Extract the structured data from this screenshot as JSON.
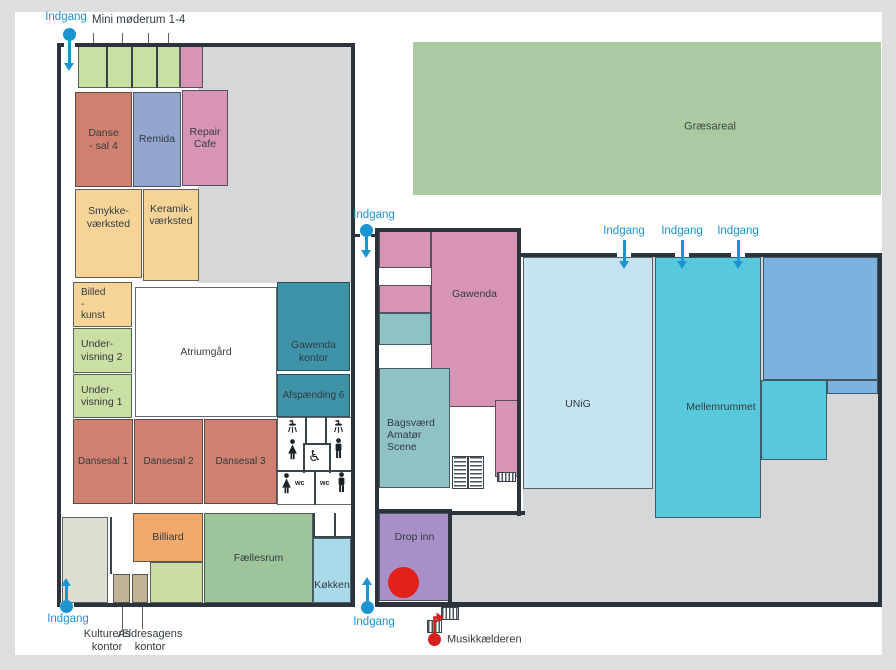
{
  "map": {
    "description": "Floor plan of community culture house with labelled rooms and entrances"
  },
  "colors": {
    "wall": "#2b343d",
    "accent_blue": "#1b95d2",
    "red": "#e2221a",
    "musik_red": "#d6201c",
    "interior_grey": "#d5d7d9",
    "grass_green": "#abcaa2"
  },
  "areas": [
    {
      "name": "left-building-interior",
      "x": 198,
      "y": 47,
      "w": 153,
      "h": 236,
      "bg": "#d5d7d9"
    },
    {
      "name": "right-building-interior",
      "x": 523,
      "y": 257,
      "w": 355,
      "h": 346,
      "bg": "#d5d7d9"
    },
    {
      "name": "right-building-interior-lower",
      "x": 452,
      "y": 513,
      "w": 426,
      "h": 90,
      "bg": "#d5d7d9"
    },
    {
      "name": "graesareal-area",
      "x": 413,
      "y": 42,
      "w": 468,
      "h": 153,
      "bg": "#abcaa2"
    }
  ],
  "rooms": [
    {
      "name": "mini-moederum-rooms",
      "label": "",
      "x": 78,
      "y": 46,
      "w": 102,
      "h": 42,
      "bg": "#c9dfa4"
    },
    {
      "name": "mini-room-pink",
      "label": "",
      "x": 180,
      "y": 46,
      "w": 23,
      "h": 42,
      "bg": "#d794b4"
    },
    {
      "name": "dansesal-4",
      "label": "Danse\n- sal 4",
      "x": 75,
      "y": 92,
      "w": 57,
      "h": 95,
      "bg": "#d0806f"
    },
    {
      "name": "remida",
      "label": "Remida",
      "x": 133,
      "y": 92,
      "w": 48,
      "h": 95,
      "bg": "#93a6cd"
    },
    {
      "name": "repair-cafe",
      "label": "Repair\nCafe",
      "x": 182,
      "y": 90,
      "w": 46,
      "h": 96,
      "bg": "#d794b4"
    },
    {
      "name": "smykkevaerksted",
      "label": "Smykke-\nværksted",
      "x": 75,
      "y": 189,
      "w": 67,
      "h": 89,
      "bg": "#f6d498",
      "dy": -16
    },
    {
      "name": "keramikvaerksted",
      "label": "Keramik-\nværksted",
      "x": 143,
      "y": 189,
      "w": 56,
      "h": 92,
      "bg": "#f6d498",
      "dy": -20
    },
    {
      "name": "billedkunst",
      "label": "Billed\n-\nkunst",
      "x": 73,
      "y": 282,
      "w": 59,
      "h": 45,
      "bg": "#f6d498",
      "align": "left",
      "fs": 10
    },
    {
      "name": "undervisning-2",
      "label": "Under-\nvisning 2",
      "x": 73,
      "y": 328,
      "w": 59,
      "h": 45,
      "bg": "#c9dfa4",
      "align": "left"
    },
    {
      "name": "undervisning-1",
      "label": "Under-\nvisning 1",
      "x": 73,
      "y": 374,
      "w": 59,
      "h": 44,
      "bg": "#c9dfa4",
      "align": "left"
    },
    {
      "name": "atriumgaard",
      "label": "Atriumgård",
      "x": 135,
      "y": 287,
      "w": 142,
      "h": 130,
      "bg": "#ffffff"
    },
    {
      "name": "gawenda-kontor",
      "label": "Gawenda\nkontor",
      "x": 277,
      "y": 282,
      "w": 73,
      "h": 89,
      "bg": "#3e93a8",
      "dy": 25
    },
    {
      "name": "afspaending-6",
      "label": "Afspænding 6",
      "x": 277,
      "y": 374,
      "w": 73,
      "h": 43,
      "bg": "#3e93a8",
      "fs": 10
    },
    {
      "name": "dansesal-1",
      "label": "Dansesal 1",
      "x": 73,
      "y": 419,
      "w": 60,
      "h": 85,
      "bg": "#d0806f",
      "fs": 10
    },
    {
      "name": "dansesal-2",
      "label": "Dansesal 2",
      "x": 134,
      "y": 419,
      "w": 69,
      "h": 85,
      "bg": "#d0806f",
      "fs": 10
    },
    {
      "name": "dansesal-3",
      "label": "Dansesal 3",
      "x": 204,
      "y": 419,
      "w": 73,
      "h": 85,
      "bg": "#d0806f",
      "fs": 10
    },
    {
      "name": "toilets",
      "label": "",
      "x": 277,
      "y": 417,
      "w": 75,
      "h": 88,
      "bg": "#ffffff"
    },
    {
      "name": "storage-room",
      "label": "",
      "x": 62,
      "y": 517,
      "w": 46,
      "h": 86,
      "bg": "#deded2"
    },
    {
      "name": "kulturens-kontor-room",
      "label": "",
      "x": 113,
      "y": 574,
      "w": 17,
      "h": 29,
      "bg": "#bfb295"
    },
    {
      "name": "aeldresagens-kontor-room",
      "label": "",
      "x": 132,
      "y": 574,
      "w": 16,
      "h": 29,
      "bg": "#bfb295"
    },
    {
      "name": "activity-room",
      "label": "",
      "x": 150,
      "y": 562,
      "w": 53,
      "h": 41,
      "bg": "#c9dca4"
    },
    {
      "name": "billiard",
      "label": "Billiard",
      "x": 133,
      "y": 513,
      "w": 70,
      "h": 49,
      "bg": "#f1a96d"
    },
    {
      "name": "faellesrum",
      "label": "Fællesrum",
      "x": 204,
      "y": 513,
      "w": 109,
      "h": 90,
      "bg": "#9ec49a"
    },
    {
      "name": "koekken",
      "label": "Køkken",
      "x": 313,
      "y": 538,
      "w": 38,
      "h": 65,
      "bg": "#a9dae9",
      "dy": 15
    },
    {
      "name": "middle-room-1",
      "label": "",
      "x": 379,
      "y": 230,
      "w": 52,
      "h": 38,
      "bg": "#d794b4"
    },
    {
      "name": "middle-room-2",
      "label": "",
      "x": 379,
      "y": 285,
      "w": 52,
      "h": 28,
      "bg": "#d794b4"
    },
    {
      "name": "middle-room-3",
      "label": "",
      "x": 379,
      "y": 313,
      "w": 52,
      "h": 32,
      "bg": "#8fc2c5"
    },
    {
      "name": "gawenda",
      "label": "Gawenda",
      "x": 431,
      "y": 230,
      "w": 87,
      "h": 177,
      "bg": "#d794b4",
      "dy": -24
    },
    {
      "name": "bagsvaerd-amatoer-scene",
      "label": "Bagsværd\nAmatør\nScene",
      "x": 379,
      "y": 368,
      "w": 71,
      "h": 120,
      "bg": "#8fc2c5",
      "align": "left",
      "dy": 7
    },
    {
      "name": "middle-room-4",
      "label": "",
      "x": 495,
      "y": 400,
      "w": 23,
      "h": 77,
      "bg": "#d794b4"
    },
    {
      "name": "drop-inn",
      "label": "Drop inn",
      "x": 379,
      "y": 513,
      "w": 71,
      "h": 88,
      "bg": "#a88fc7",
      "dy": -20
    },
    {
      "name": "unig",
      "label": "UNiG",
      "x": 523,
      "y": 257,
      "w": 130,
      "h": 232,
      "bg": "#c5e4ef",
      "dx": -10,
      "dy": 31
    },
    {
      "name": "mellemrummet",
      "label": "Mellemrummet",
      "x": 655,
      "y": 257,
      "w": 106,
      "h": 261,
      "bg": "#58c8dd",
      "dx": 13,
      "dy": 20
    },
    {
      "name": "mellemrummet-extension",
      "label": "",
      "x": 761,
      "y": 380,
      "w": 66,
      "h": 80,
      "bg": "#58c8dd"
    },
    {
      "name": "blue-room",
      "label": "",
      "x": 763,
      "y": 257,
      "w": 115,
      "h": 123,
      "bg": "#7cb2dd"
    },
    {
      "name": "blue-room-step",
      "label": "",
      "x": 827,
      "y": 380,
      "w": 51,
      "h": 14,
      "bg": "#7cb2dd"
    }
  ],
  "walls": [
    {
      "x": 57,
      "y": 43,
      "w": 298,
      "h": 4
    },
    {
      "x": 57,
      "y": 43,
      "w": 4,
      "h": 564
    },
    {
      "x": 57,
      "y": 603,
      "w": 298,
      "h": 4
    },
    {
      "x": 351,
      "y": 43,
      "w": 4,
      "h": 564
    },
    {
      "x": 375,
      "y": 228,
      "w": 146,
      "h": 4
    },
    {
      "x": 375,
      "y": 228,
      "w": 4,
      "h": 379
    },
    {
      "x": 517,
      "y": 228,
      "w": 4,
      "h": 288
    },
    {
      "x": 448,
      "y": 511,
      "w": 4,
      "h": 96
    },
    {
      "x": 450,
      "y": 511,
      "w": 75,
      "h": 4
    },
    {
      "x": 375,
      "y": 509,
      "w": 77,
      "h": 4
    },
    {
      "x": 375,
      "y": 602,
      "w": 507,
      "h": 5
    },
    {
      "x": 520,
      "y": 253,
      "w": 362,
      "h": 4
    },
    {
      "x": 878,
      "y": 253,
      "w": 4,
      "h": 354
    },
    {
      "x": 351,
      "y": 234,
      "w": 9,
      "h": 3
    },
    {
      "x": 371,
      "y": 234,
      "w": 8,
      "h": 3
    }
  ],
  "wall_gaps": [
    {
      "x": 64,
      "y": 43,
      "w": 11,
      "h": 4
    },
    {
      "x": 60,
      "y": 603,
      "w": 14,
      "h": 4
    },
    {
      "x": 617,
      "y": 253,
      "w": 14,
      "h": 4
    },
    {
      "x": 675,
      "y": 253,
      "w": 14,
      "h": 4
    },
    {
      "x": 731,
      "y": 253,
      "w": 14,
      "h": 4
    }
  ],
  "thin_walls": [
    {
      "x": 106,
      "y": 46,
      "w": 2,
      "h": 42
    },
    {
      "x": 131,
      "y": 46,
      "w": 2,
      "h": 42
    },
    {
      "x": 156,
      "y": 46,
      "w": 2,
      "h": 42
    },
    {
      "x": 277,
      "y": 470,
      "w": 75,
      "h": 2
    },
    {
      "x": 314,
      "y": 470,
      "w": 2,
      "h": 35
    },
    {
      "x": 303,
      "y": 443,
      "w": 28,
      "h": 2
    },
    {
      "x": 303,
      "y": 443,
      "w": 2,
      "h": 30
    },
    {
      "x": 329,
      "y": 443,
      "w": 2,
      "h": 30
    },
    {
      "x": 305,
      "y": 417,
      "w": 2,
      "h": 28
    },
    {
      "x": 325,
      "y": 417,
      "w": 2,
      "h": 28
    },
    {
      "x": 313,
      "y": 513,
      "w": 2,
      "h": 25
    },
    {
      "x": 313,
      "y": 536,
      "w": 38,
      "h": 2
    },
    {
      "x": 334,
      "y": 513,
      "w": 2,
      "h": 24
    },
    {
      "x": 110,
      "y": 517,
      "w": 2,
      "h": 57
    }
  ],
  "stairs": [
    {
      "name": "stairs-middle-building",
      "type": "double",
      "x": 452,
      "y": 456,
      "w": 32,
      "h": 33
    },
    {
      "name": "stairs-small-east",
      "type": "v",
      "x": 497,
      "y": 472,
      "w": 19,
      "h": 10
    },
    {
      "name": "stairs-musik-upper",
      "type": "v",
      "x": 441,
      "y": 607,
      "w": 18,
      "h": 13
    },
    {
      "name": "stairs-musik-lower",
      "type": "v",
      "x": 427,
      "y": 620,
      "w": 15,
      "h": 13
    }
  ],
  "toilet_icons": [
    {
      "type": "shower",
      "x": 286,
      "y": 419
    },
    {
      "type": "female",
      "x": 287,
      "y": 439
    },
    {
      "type": "shower",
      "x": 332,
      "y": 419
    },
    {
      "type": "male",
      "x": 333,
      "y": 438
    },
    {
      "type": "wheelchair",
      "x": 308,
      "y": 447
    },
    {
      "type": "female",
      "x": 281,
      "y": 473
    },
    {
      "type": "wctext",
      "x": 295,
      "y": 480,
      "text": "wc"
    },
    {
      "type": "wctext",
      "x": 320,
      "y": 480,
      "text": "wc"
    },
    {
      "type": "male",
      "x": 336,
      "y": 472
    }
  ],
  "markers": {
    "drop_inn_circle": {
      "x": 388,
      "y": 567,
      "d": 31,
      "color": "#e2221a"
    },
    "musik_pin": {
      "x": 428,
      "y": 633,
      "d": 13,
      "color": "#d6201c"
    }
  },
  "entrances": [
    {
      "name": "entrance-top-left",
      "pin": {
        "x": 69,
        "y": 34
      },
      "arrow": {
        "x": 69,
        "y1": 41,
        "y2": 71,
        "dir": "down"
      },
      "label": {
        "text": "Indgang",
        "x": 66,
        "y": 17
      }
    },
    {
      "name": "entrance-mid-top",
      "pin": {
        "x": 366,
        "y": 230
      },
      "arrow": {
        "x": 366,
        "y1": 236,
        "y2": 258,
        "dir": "down"
      },
      "label": {
        "text": "Indgang",
        "x": 374,
        "y": 215
      }
    },
    {
      "name": "entrance-bottom-left",
      "pin": {
        "x": 66,
        "y": 606
      },
      "arrow": {
        "x": 66,
        "y1": 600,
        "y2": 578,
        "dir": "up"
      },
      "label": {
        "text": "Indgang",
        "x": 68,
        "y": 619
      }
    },
    {
      "name": "entrance-bottom-mid",
      "pin": {
        "x": 367,
        "y": 607
      },
      "arrow": {
        "x": 367,
        "y1": 601,
        "y2": 577,
        "dir": "up"
      },
      "label": {
        "text": "Indgang",
        "x": 374,
        "y": 622
      }
    },
    {
      "name": "entrance-right-1",
      "arrow": {
        "x": 624,
        "y1": 240,
        "y2": 269,
        "dir": "down"
      },
      "label": {
        "text": "Indgang",
        "x": 624,
        "y": 231
      }
    },
    {
      "name": "entrance-right-2",
      "arrow": {
        "x": 682,
        "y1": 240,
        "y2": 269,
        "dir": "down"
      },
      "label": {
        "text": "Indgang",
        "x": 682,
        "y": 231
      }
    },
    {
      "name": "entrance-right-3",
      "arrow": {
        "x": 738,
        "y1": 240,
        "y2": 269,
        "dir": "down"
      },
      "label": {
        "text": "Indgang",
        "x": 738,
        "y": 231
      }
    }
  ],
  "callout_lines": [
    {
      "x": 93,
      "y": 33,
      "w": 1,
      "h": 10
    },
    {
      "x": 122,
      "y": 33,
      "w": 1,
      "h": 10
    },
    {
      "x": 148,
      "y": 33,
      "w": 1,
      "h": 10
    },
    {
      "x": 168,
      "y": 33,
      "w": 1,
      "h": 10
    },
    {
      "x": 122,
      "y": 607,
      "w": 1,
      "h": 22
    },
    {
      "x": 142,
      "y": 607,
      "w": 1,
      "h": 22
    }
  ],
  "labels": [
    {
      "name": "mini-moederum-label",
      "text": "Mini møderum 1-4",
      "x": 92,
      "y": 21,
      "anchor": "left",
      "color": "#333b41",
      "fs": 11.5
    },
    {
      "name": "kulturens-kontor-label",
      "text": "Kulturens\nkontor",
      "x": 107,
      "y": 641,
      "anchor": "center",
      "color": "#333b41",
      "fs": 11
    },
    {
      "name": "aeldresagens-kontor-label",
      "text": "Ældresagens\nkontor",
      "x": 150,
      "y": 641,
      "anchor": "center",
      "color": "#333b41",
      "fs": 11
    },
    {
      "name": "musikkaelderen-label",
      "text": "Musikkælderen",
      "x": 447,
      "y": 640,
      "anchor": "left",
      "color": "#333b41",
      "fs": 11
    },
    {
      "name": "graesareal-label",
      "text": "Græsareal",
      "x": 710,
      "y": 127,
      "anchor": "center",
      "color": "#3f4b44",
      "fs": 11
    }
  ]
}
